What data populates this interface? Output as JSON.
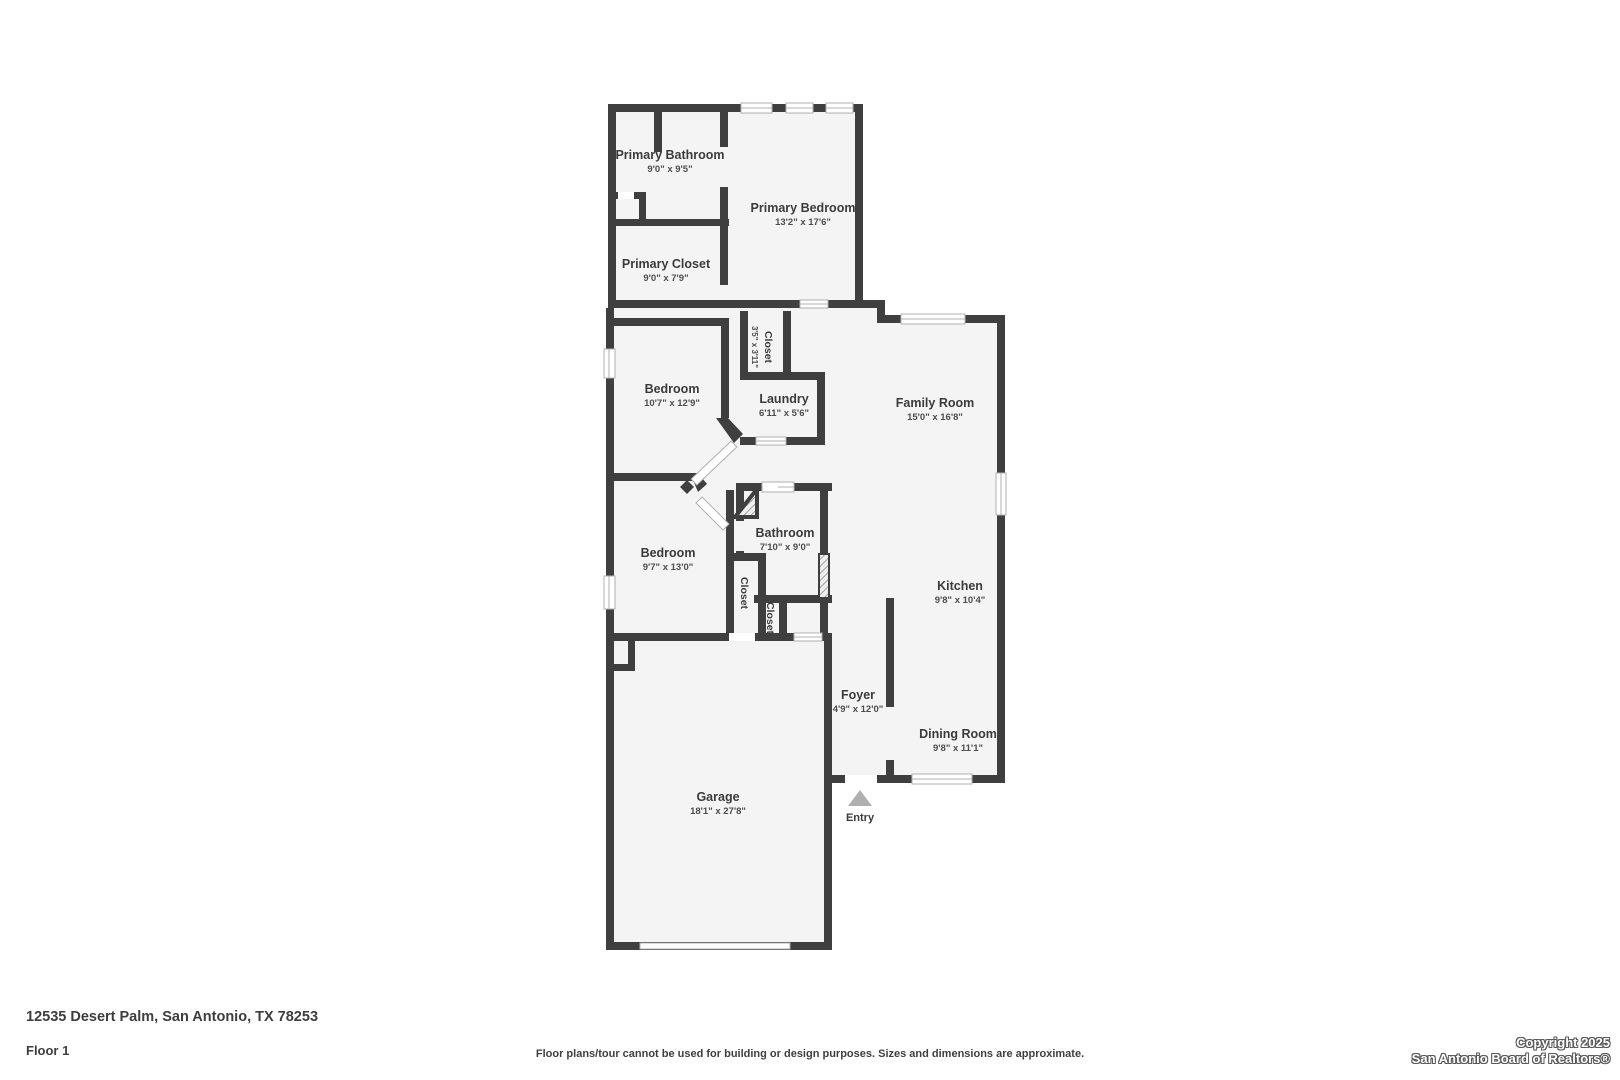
{
  "footer": {
    "address": "12535 Desert Palm, San Antonio, TX 78253",
    "floor": "Floor 1",
    "disclaimer": "Floor plans/tour cannot be used for building or design purposes. Sizes and dimensions are approximate.",
    "copyright_line1": "Copyright 2025",
    "copyright_line2": "San Antonio Board of Realtors®"
  },
  "colors": {
    "wall": "#3f3f3f",
    "floor": "#f4f4f4",
    "label": "#3b3b3b",
    "window_stroke": "#b0b0b0",
    "entry_triangle": "#b0b0b0"
  },
  "rooms": {
    "primary_bathroom": {
      "name": "Primary Bathroom",
      "dims": "9'0\" x 9'5\""
    },
    "primary_closet": {
      "name": "Primary Closet",
      "dims": "9'0\" x 7'9\""
    },
    "primary_bedroom": {
      "name": "Primary Bedroom",
      "dims": "13'2\" x 17'6\""
    },
    "closet_hall": {
      "name": "Closet",
      "dims": "3'5\" x 3'11\""
    },
    "bedroom_1": {
      "name": "Bedroom",
      "dims": "10'7\" x 12'9\""
    },
    "laundry": {
      "name": "Laundry",
      "dims": "6'11\" x 5'6\""
    },
    "family_room": {
      "name": "Family Room",
      "dims": "15'0\" x 16'8\""
    },
    "bathroom": {
      "name": "Bathroom",
      "dims": "7'10\" x 9'0\""
    },
    "bedroom_2": {
      "name": "Bedroom",
      "dims": "9'7\" x 13'0\""
    },
    "closet_1": {
      "name": "Closet"
    },
    "closet_2": {
      "name": "Closet"
    },
    "kitchen": {
      "name": "Kitchen",
      "dims": "9'8\" x 10'4\""
    },
    "foyer": {
      "name": "Foyer",
      "dims": "4'9\" x 12'0\""
    },
    "dining_room": {
      "name": "Dining Room",
      "dims": "9'8\" x 11'1\""
    },
    "garage": {
      "name": "Garage",
      "dims": "18'1\" x 27'8\""
    },
    "entry": {
      "name": "Entry"
    }
  }
}
